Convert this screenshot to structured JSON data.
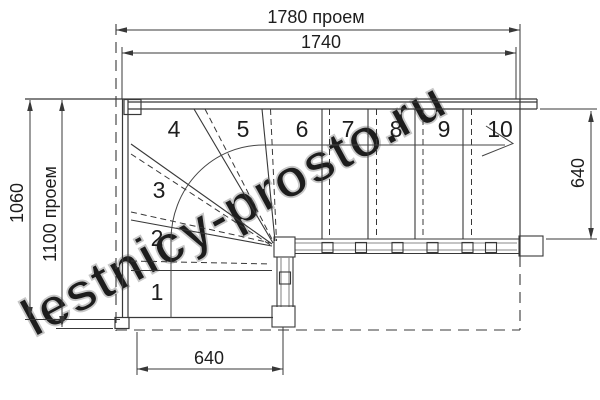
{
  "title": "Winder staircase plan drawing",
  "watermark": "lestnicy-prosto.ru",
  "dimensions": {
    "top_outer": "1780 проем",
    "top_inner": "1740",
    "left_outer": "1060",
    "left_inner": "1100 проем",
    "bottom": "640",
    "right": "640"
  },
  "steps": {
    "labels": [
      "1",
      "2",
      "3",
      "4",
      "5",
      "6",
      "7",
      "8",
      "9",
      "10"
    ]
  },
  "colors": {
    "line": "#383838",
    "minor_line": "#8a8a8a",
    "watermark": "#c7c7c7",
    "background": "#ffffff"
  }
}
